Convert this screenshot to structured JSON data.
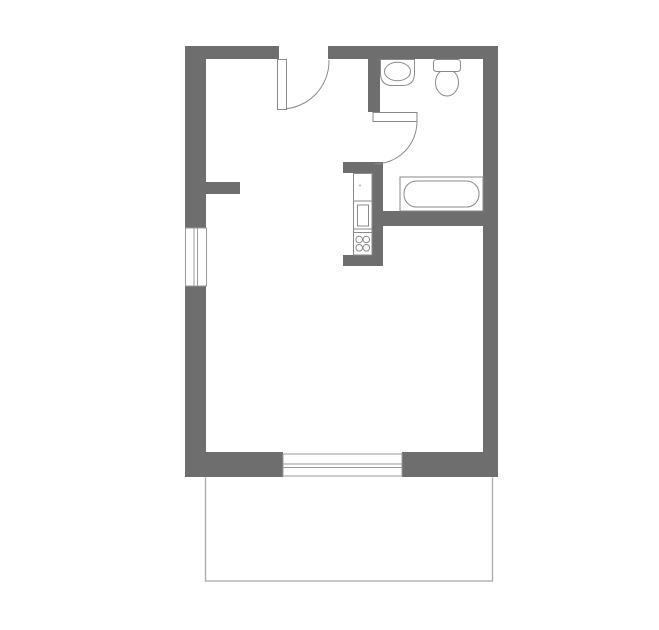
{
  "plan": {
    "type": "floor-plan",
    "symbols": [
      "exterior-wall",
      "interior-wall",
      "window",
      "entrance-door",
      "bathroom-door",
      "door-swing-arc",
      "sink",
      "toilet",
      "bathtub",
      "kitchen-counter",
      "oven",
      "stove-burners",
      "balcony-outline"
    ]
  },
  "colors": {
    "wall": "#6e6e6e",
    "fixture_outline": "#8a8a8a",
    "window_outline": "#9a9a9a",
    "balcony_outline": "#a9a9a9",
    "surface": "#ffffff",
    "detail_dot": "#b0b0b0",
    "background": "#ffffff"
  }
}
